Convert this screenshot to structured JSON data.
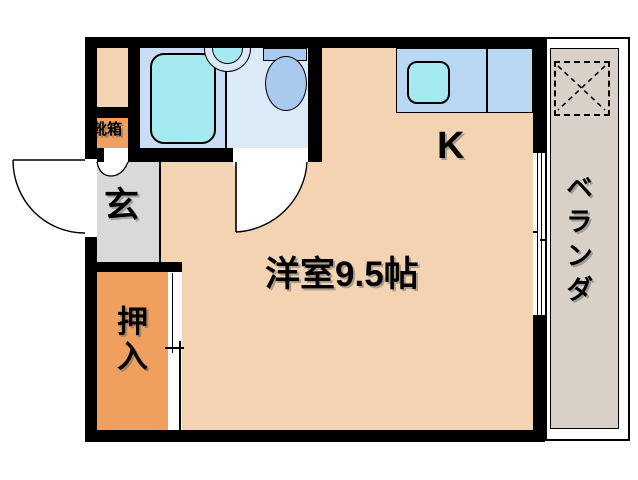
{
  "floorplan": {
    "labels": {
      "main_room": "洋室9.5帖",
      "kitchen": "K",
      "entrance": "玄",
      "closet": "押入",
      "shoe_box": "靴箱",
      "veranda": "ベランダ"
    },
    "colors": {
      "wall": "#000000",
      "background": "#ffffff",
      "main_room": "#f3d3b1",
      "closet": "#efa05f",
      "shoe_box": "#efa05f",
      "shoe_upper": "#f3d3b1",
      "entrance_floor": "#d9d9d9",
      "veranda_floor": "#d9d1c8",
      "counter": "#b9d8f4",
      "bath_floor": "#c9def4",
      "toilet_floor": "#dceaf8",
      "fixture_cyan": "#a5eaf0",
      "fixture_blue": "#aac9ee",
      "opening_white": "#ffffff"
    }
  }
}
